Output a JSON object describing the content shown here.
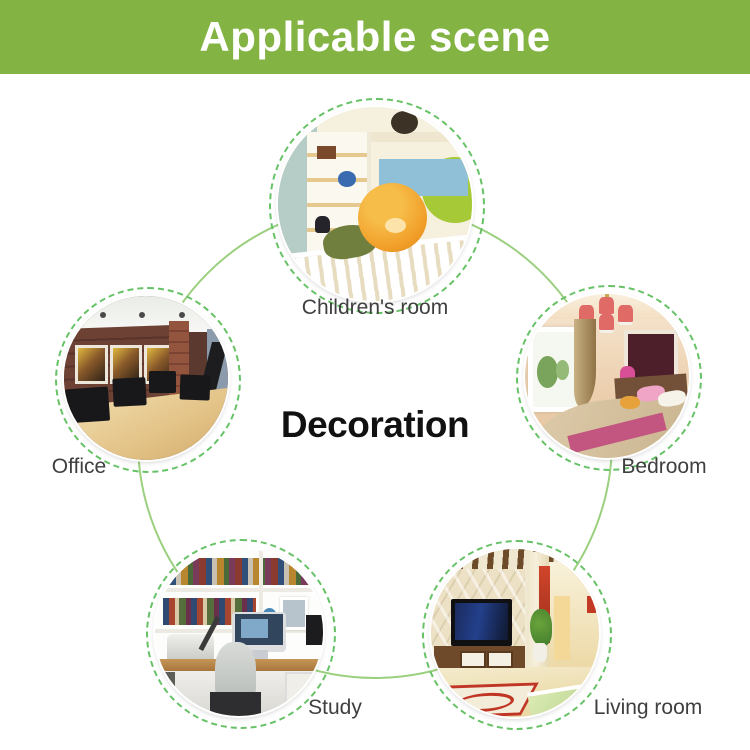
{
  "header": {
    "title": "Applicable scene"
  },
  "center": {
    "title": "Decoration"
  },
  "nodes": [
    {
      "id": "childrens-room",
      "label": "Children's room"
    },
    {
      "id": "office",
      "label": "Office"
    },
    {
      "id": "bedroom",
      "label": "Bedroom"
    },
    {
      "id": "study",
      "label": "Study"
    },
    {
      "id": "living-room",
      "label": "Living room"
    }
  ],
  "colors": {
    "banner_green": "#83b443",
    "banner_text": "#ffffff",
    "connector_green": "#9bd07e",
    "dashed_ring_green": "#67c267",
    "label_text": "#3f3f3f",
    "center_text": "#111111"
  }
}
